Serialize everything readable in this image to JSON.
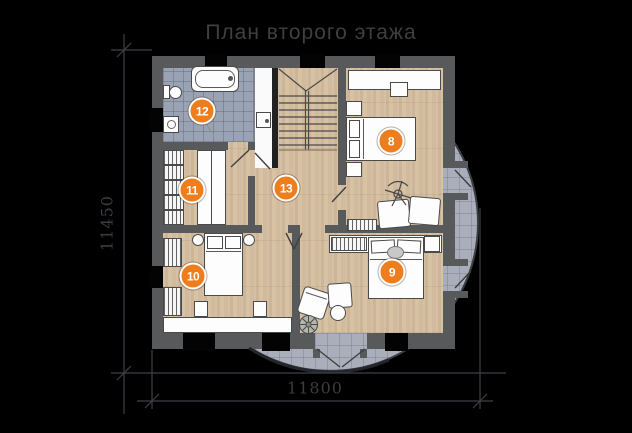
{
  "title": "План второго этажа",
  "dimensions": {
    "vertical_label": "11450",
    "horizontal_label": "11800"
  },
  "room_markers": [
    {
      "number": "8"
    },
    {
      "number": "9"
    },
    {
      "number": "10"
    },
    {
      "number": "11"
    },
    {
      "number": "12"
    },
    {
      "number": "13"
    }
  ],
  "colors": {
    "background": "#000000",
    "marker_orange": "#ee7d1d",
    "wall_gray": "#58595b",
    "wood_floor": "#d8c2a4",
    "bathroom_tile": "#9aa3b3",
    "balcony_tile": "#a9aeba",
    "linework": "#3d4045",
    "title_text": "#3f3f3f"
  }
}
